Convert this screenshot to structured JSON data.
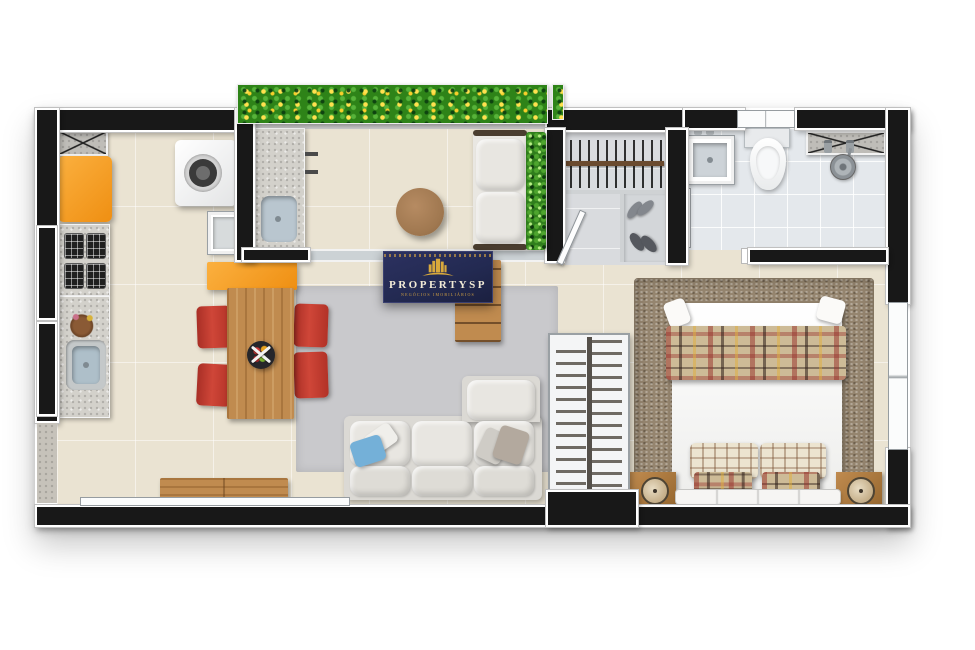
{
  "watermark": {
    "brand": "PROPERTYSP",
    "tagline": "NEGÓCIOS IMOBILIÁRIOS",
    "icon": "building-skyline-icon"
  },
  "palette": {
    "wall": "#181818",
    "floor_main": "#eae3d2",
    "floor_bath": "#e4e8ec",
    "floor_closet": "#d9dbde",
    "rug_living": "#c9c9cc",
    "rug_bedroom": "#95856f",
    "orange": "#ef8f12",
    "chair_red": "#cf4638",
    "wood": "#c08b4f",
    "sofa": "#dbd9d4",
    "pillow_blue": "#74b0d8",
    "glass": "#ccd2d5",
    "flower_yellow": "#ffe14e",
    "plant_green": "#2e8318",
    "logo_navy": "#232a52",
    "logo_gold": "#d2a243"
  },
  "scene": {
    "type": "apartment-floor-plan-top-view",
    "rooms": [
      {
        "name": "kitchen",
        "furniture": [
          "countertop-cabinet",
          "refrigerator",
          "cooktop",
          "kitchen-counter",
          "kitchen-sink",
          "flower-vase",
          "washing-machine",
          "laundry-tank"
        ]
      },
      {
        "name": "gourmet-balcony",
        "furniture": [
          "planter-flowerbed",
          "balcony-counter",
          "balcony-sink",
          "wall-shelves",
          "round-coffee-table",
          "balcony-sofa",
          "hedge-planter"
        ]
      },
      {
        "name": "living-dining",
        "furniture": [
          "peninsula-counter",
          "dining-table",
          "dining-chairs",
          "fruit-bowl",
          "area-rug",
          "sectional-sofa",
          "throw-pillows",
          "sideboard",
          "tv-shelf"
        ],
        "dining_chairs_count": 4
      },
      {
        "name": "closet-hall",
        "furniture": [
          "clothes-rail",
          "shoe-shelf",
          "shoes",
          "door-leaf"
        ]
      },
      {
        "name": "bathroom",
        "furniture": [
          "washbasin",
          "toilet",
          "shower",
          "vanity-cabinet",
          "glass-partition",
          "window"
        ]
      },
      {
        "name": "bedroom",
        "furniture": [
          "double-bed",
          "plaid-blanket",
          "bed-pillows",
          "headboard",
          "nightstand-left",
          "nightstand-right",
          "alarm-clocks",
          "shag-rug",
          "wardrobe-rail",
          "window"
        ]
      }
    ]
  }
}
